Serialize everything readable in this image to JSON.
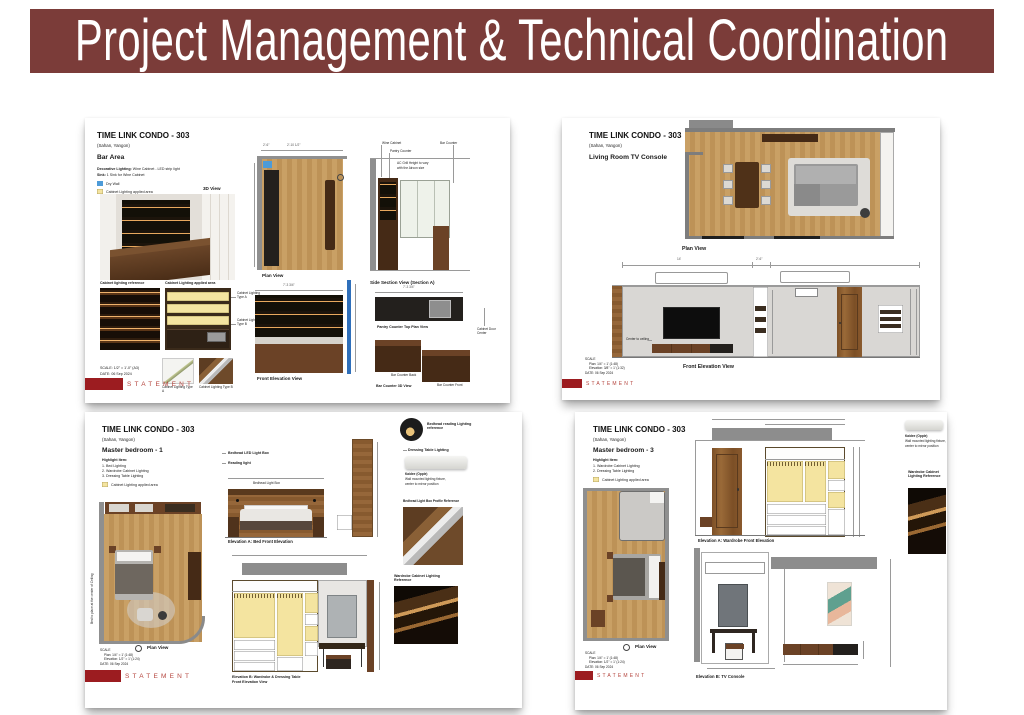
{
  "banner": {
    "title": "Project Management & Technical Coordination"
  },
  "brand": "STATEMENT",
  "bar": {
    "title": "TIME LINK CONDO - 303",
    "location": "(Sahan, Yangon)",
    "room": "Bar Area",
    "note1_label": "Decorative Lighting:",
    "note1_text": "Wine Cabinet - LED strip light",
    "note2_label": "Sink:",
    "note2_text": "1 Sink for Wine Cabinet",
    "legend_drywall": "Dry Wall",
    "legend_cabinet": "Cabinet Lighting applied area",
    "view_3d": "3D View",
    "plan": "Plan View",
    "side_section": "Side Section View (Section A)",
    "wine_cabinet": "Wine Cabinet",
    "pantry_counter": "Pantry Counter",
    "bar_counter": "Bar Counter",
    "ac_note1": "AC Grill Height to vary",
    "ac_note2": "with the Aircon size",
    "cab_ref": "Cabinet lighting reference",
    "cab_applied": "Cabinet Lighting applied area",
    "type_a": "Cabinet Lighting Type A",
    "type_b": "Cabinet Lighting Type B",
    "pantry_top": "Pantry Counter Top Plan View",
    "door_center": "Cabinet Door Center",
    "front_elev": "Front Elevation View",
    "bar_3d": "Bar Counter 3D View",
    "bar_back": "Bar Counter Back",
    "bar_front": "Bar Counter Front",
    "dim_a": "2'-6\"",
    "dim_b": "2'-10 1/2\"",
    "dim_w": "7'-3 3/4\"",
    "scale": "SCALE: 1/2\" = 1'-0\" (A3)",
    "date": "DATE: 06 Sep 2024"
  },
  "living": {
    "title": "TIME LINK CONDO - 303",
    "location": "(Sahan, Yangon)",
    "room": "Living Room TV Console",
    "plan": "Plan View",
    "front_elev": "Front Elevation View",
    "center_ceiling": "Center to ceiling",
    "dim_14": "14'",
    "dim_26": "2'-6\"",
    "scale1": "SCALE",
    "scale2": "Plan: 1/4\" = 1' (1:48)",
    "scale3": "Elevation: 3/8\" = 1' (1:32)",
    "date": "DATE: 06 Sep 2024"
  },
  "bed1": {
    "title": "TIME LINK CONDO - 303",
    "location": "(Sahan, Yangon)",
    "room": "Master bedroom - 1",
    "highlight": "Highlight Item:",
    "item1": "1. Bed Lighting",
    "item2": "2. Wardrobe Cabinet Lighting",
    "item3": "3. Dressing Table Lighting",
    "legend_cabinet": "Cabinet Lighting applied area",
    "bedhead_led": "Bedhead LED Light Box",
    "reading": "Reading light",
    "bedhead_box": "Bedhead Light Box",
    "elev_a": "Elevation A: Bed Front Elevation",
    "ref_reading": "Bedhead reading Lighting reference",
    "ref_dressing": "Dressing Table Lighting",
    "kaidee": "Kaidee (Opple)",
    "wallmount1": "Wall mounted lighting fixture,",
    "wallmount2": "center to mirror position",
    "profile_ref": "Bedhead Light Box Profile Reference",
    "wardrobe_ref": "Wardrobe Cabinet Lighting Reference",
    "bed_note": "Bed to place at the center of Ceiling",
    "plan": "Plan View",
    "elev_b1": "Elevation B: Wardrobe & Dressing Table",
    "elev_b2": "Front Elevation View",
    "scale1": "SCALE",
    "scale2": "Plan: 1/4\" = 1' (1:48)",
    "scale3": "Elevation: 1/2\" = 1' (1:24)",
    "date": "DATE: 06 Sep 2024"
  },
  "bed3": {
    "title": "TIME LINK CONDO - 303",
    "location": "(Sahan, Yangon)",
    "room": "Master bedroom - 3",
    "highlight": "Highlight Item:",
    "item1": "1. Wardrobe Cabinet Lighting",
    "item2": "2. Dressing Table Lighting",
    "legend_cabinet": "Cabinet Lighting applied area",
    "elev_a": "Elevation A: Wardrobe Front Elevation",
    "kaidee": "Kaidee (Opple)",
    "wallmount1": "Wall mounted lighting fixture,",
    "wallmount2": "center to mirror position",
    "wardrobe_ref": "Wardrobe Cabinet Lighting Reference",
    "plan": "Plan View",
    "elev_b": "Elevation B: TV Console",
    "scale1": "SCALE",
    "scale2": "Plan: 1/4\" = 1' (1:48)",
    "scale3": "Elevation: 1/2\" = 1' (1:24)",
    "date": "DATE: 06 Sep 2024"
  }
}
